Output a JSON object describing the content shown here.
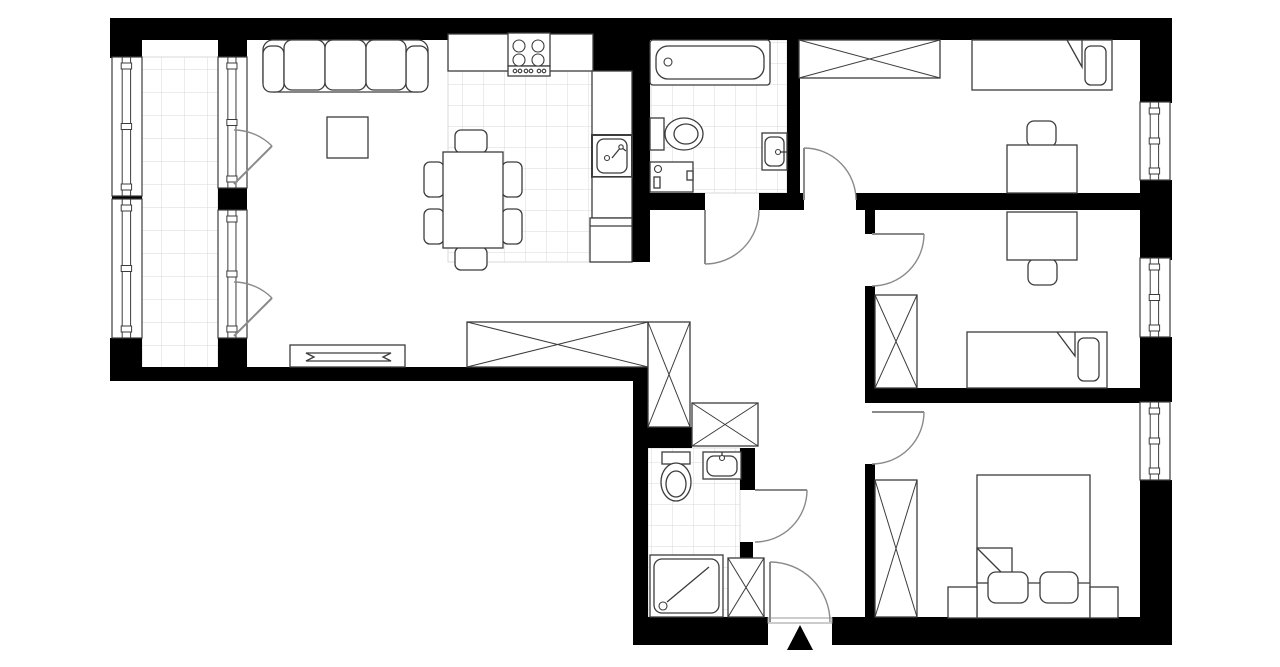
{
  "canvas": {
    "w": 1280,
    "h": 667
  },
  "palette": {
    "wall": "#000000",
    "furniture_line": "#3c3c3c",
    "door_line": "#8a8a8a",
    "tile_line": "#d9d9d9",
    "paper": "#ffffff",
    "threshold": "#9a9a9a"
  },
  "tile_areas": [
    {
      "name": "balcony-tiles",
      "x": 142,
      "y": 57,
      "w": 76,
      "h": 311,
      "cell": 23
    },
    {
      "name": "kitchen-tiles",
      "x": 448,
      "y": 71,
      "w": 184,
      "h": 191,
      "cell": 21
    },
    {
      "name": "bathroom1-tiles",
      "x": 650,
      "y": 40,
      "w": 137,
      "h": 153,
      "cell": 21
    },
    {
      "name": "bathroom2-tiles",
      "x": 648,
      "y": 448,
      "w": 92,
      "h": 169,
      "cell": 21
    }
  ],
  "walls": [
    {
      "name": "wall-top",
      "x": 110,
      "y": 18,
      "w": 1062,
      "h": 22
    },
    {
      "name": "wall-balcony-left-top",
      "x": 110,
      "y": 40,
      "w": 32,
      "h": 18
    },
    {
      "name": "wall-balcony-left-mid",
      "x": 112,
      "y": 194,
      "w": 30,
      "h": 5
    },
    {
      "name": "wall-balcony-left-bot",
      "x": 110,
      "y": 338,
      "w": 32,
      "h": 43
    },
    {
      "name": "wall-balcony-inner-top",
      "x": 218,
      "y": 40,
      "w": 29,
      "h": 18
    },
    {
      "name": "wall-balcony-inner-mid",
      "x": 218,
      "y": 188,
      "w": 29,
      "h": 22
    },
    {
      "name": "wall-balcony-inner-bot",
      "x": 218,
      "y": 338,
      "w": 29,
      "h": 43
    },
    {
      "name": "wall-living-bottom",
      "x": 110,
      "y": 367,
      "w": 538,
      "h": 14
    },
    {
      "name": "wall-kitchen-shaft",
      "x": 593,
      "y": 20,
      "w": 57,
      "h": 52
    },
    {
      "name": "wall-kitchen-bath",
      "x": 632,
      "y": 40,
      "w": 18,
      "h": 222
    },
    {
      "name": "wall-hall-north-1",
      "x": 632,
      "y": 193,
      "w": 73,
      "h": 17
    },
    {
      "name": "wall-hall-north-2",
      "x": 759,
      "y": 193,
      "w": 45,
      "h": 17
    },
    {
      "name": "wall-bedroom1-bottom",
      "x": 856,
      "y": 193,
      "w": 284,
      "h": 17
    },
    {
      "name": "wall-bath1-east",
      "x": 787,
      "y": 20,
      "w": 13,
      "h": 175
    },
    {
      "name": "wall-hall-east-a",
      "x": 865,
      "y": 210,
      "w": 10,
      "h": 24
    },
    {
      "name": "wall-hall-east-b",
      "x": 865,
      "y": 286,
      "w": 10,
      "h": 117
    },
    {
      "name": "wall-bedroom2-bottom",
      "x": 875,
      "y": 388,
      "w": 265,
      "h": 15
    },
    {
      "name": "wall-hall-east-c",
      "x": 865,
      "y": 464,
      "w": 10,
      "h": 155
    },
    {
      "name": "wall-hall-west-step",
      "x": 633,
      "y": 367,
      "w": 15,
      "h": 250
    },
    {
      "name": "wall-bath2-top",
      "x": 633,
      "y": 427,
      "w": 59,
      "h": 21
    },
    {
      "name": "wall-bath2-east-top",
      "x": 740,
      "y": 448,
      "w": 15,
      "h": 42
    },
    {
      "name": "wall-bath2-east-low",
      "x": 740,
      "y": 542,
      "w": 13,
      "h": 20
    },
    {
      "name": "wall-bottom-west",
      "x": 633,
      "y": 617,
      "w": 135,
      "h": 28
    },
    {
      "name": "wall-bottom-east",
      "x": 832,
      "y": 617,
      "w": 340,
      "h": 28
    },
    {
      "name": "wall-right-seg1",
      "x": 1140,
      "y": 40,
      "w": 32,
      "h": 63
    },
    {
      "name": "wall-right-seg2",
      "x": 1140,
      "y": 180,
      "w": 32,
      "h": 80
    },
    {
      "name": "wall-right-seg3",
      "x": 1140,
      "y": 337,
      "w": 32,
      "h": 65
    },
    {
      "name": "wall-right-seg4",
      "x": 1140,
      "y": 480,
      "w": 32,
      "h": 165
    }
  ],
  "windows": [
    {
      "name": "balcony-window-1",
      "x": 112,
      "y": 57,
      "w": 30,
      "h": 139
    },
    {
      "name": "balcony-window-2",
      "x": 112,
      "y": 199,
      "w": 30,
      "h": 139
    },
    {
      "name": "balcony-door-window-1",
      "x": 218,
      "y": 57,
      "w": 29,
      "h": 131
    },
    {
      "name": "balcony-door-window-2",
      "x": 218,
      "y": 210,
      "w": 29,
      "h": 128
    },
    {
      "name": "bedroom1-window",
      "x": 1140,
      "y": 102,
      "w": 30,
      "h": 78
    },
    {
      "name": "bedroom2-window",
      "x": 1140,
      "y": 258,
      "w": 30,
      "h": 79
    },
    {
      "name": "bedroom3-window",
      "x": 1140,
      "y": 402,
      "w": 30,
      "h": 78
    }
  ],
  "wardrobes": [
    {
      "name": "wardrobe-living",
      "x": 467,
      "y": 322,
      "w": 181,
      "h": 45
    },
    {
      "name": "wardrobe-hall",
      "x": 648,
      "y": 322,
      "w": 42,
      "h": 105
    },
    {
      "name": "wardrobe-hall-2",
      "x": 692,
      "y": 403,
      "w": 66,
      "h": 43
    },
    {
      "name": "wardrobe-bedroom1",
      "x": 799,
      "y": 40,
      "w": 141,
      "h": 38
    },
    {
      "name": "wardrobe-bedroom2",
      "x": 875,
      "y": 295,
      "w": 42,
      "h": 93
    },
    {
      "name": "wardrobe-bedroom3",
      "x": 875,
      "y": 480,
      "w": 42,
      "h": 137
    },
    {
      "name": "cabinet-entry",
      "x": 728,
      "y": 558,
      "w": 36,
      "h": 59
    }
  ],
  "doors": [
    {
      "name": "bathroom1-door",
      "leaf": [
        705,
        210,
        705,
        264
      ],
      "arc": "M 705 264 A 54 54 0 0 0 759 210"
    },
    {
      "name": "bedroom1-door",
      "leaf": [
        804,
        200,
        804,
        148
      ],
      "arc": "M 804 148 A 52 52 0 0 1 856 200"
    },
    {
      "name": "bedroom2-door",
      "leaf": [
        872,
        234,
        924,
        234
      ],
      "arc": "M 924 234 A 52 52 0 0 1 872 286"
    },
    {
      "name": "bedroom3-door",
      "leaf": [
        872,
        412,
        924,
        412
      ],
      "arc": "M 924 412 A 52 52 0 0 1 872 464"
    },
    {
      "name": "bathroom2-door",
      "leaf": [
        755,
        490,
        807,
        490
      ],
      "arc": "M 807 490 A 52 52 0 0 1 755 542"
    },
    {
      "name": "entrance-door",
      "leaf": [
        770,
        622,
        770,
        562
      ],
      "arc": "M 770 562 A 60 60 0 0 1 830 622"
    },
    {
      "name": "balcony-door-1",
      "leaf": [
        234,
        184,
        272,
        146
      ],
      "arc": "M 234 130 A 54 54 0 0 1 272 146"
    },
    {
      "name": "balcony-door-2",
      "leaf": [
        234,
        336,
        272,
        298
      ],
      "arc": "M 234 282 A 54 54 0 0 1 272 298"
    }
  ],
  "shapes": [
    {
      "el": "rect",
      "name": "entrance-threshold",
      "x": 768,
      "y": 618,
      "w": 64,
      "h": 5,
      "s": "#9a9a9a",
      "sw": 1
    },
    {
      "el": "rect",
      "name": "sofa-body",
      "x": 263,
      "y": 40,
      "w": 165,
      "h": 52,
      "rx": 10
    },
    {
      "el": "rect",
      "name": "sofa-armrest",
      "x": 263,
      "y": 46,
      "w": 21,
      "h": 46,
      "rx": 8
    },
    {
      "el": "rect",
      "name": "sofa-armrest",
      "x": 406,
      "y": 46,
      "w": 22,
      "h": 46,
      "rx": 8
    },
    {
      "el": "rect",
      "name": "sofa-cushion",
      "x": 284,
      "y": 40,
      "w": 41,
      "h": 50,
      "rx": 8
    },
    {
      "el": "rect",
      "name": "sofa-cushion",
      "x": 325,
      "y": 40,
      "w": 41,
      "h": 50,
      "rx": 8
    },
    {
      "el": "rect",
      "name": "sofa-cushion",
      "x": 366,
      "y": 40,
      "w": 40,
      "h": 50,
      "rx": 8
    },
    {
      "el": "rect",
      "name": "coffee-table",
      "x": 327,
      "y": 117,
      "w": 41,
      "h": 41
    },
    {
      "el": "rect",
      "name": "tv-stand",
      "x": 290,
      "y": 345,
      "w": 115,
      "h": 22
    },
    {
      "el": "polygon",
      "name": "tv",
      "pts": "306,353 391,353 383,357 391,361 306,361 314,357"
    },
    {
      "el": "rect",
      "name": "dining-chair",
      "x": 455,
      "y": 130,
      "w": 32,
      "h": 23,
      "rx": 6
    },
    {
      "el": "rect",
      "name": "dining-chair",
      "x": 455,
      "y": 247,
      "w": 32,
      "h": 23,
      "rx": 6
    },
    {
      "el": "rect",
      "name": "dining-chair",
      "x": 424,
      "y": 162,
      "w": 20,
      "h": 35,
      "rx": 6
    },
    {
      "el": "rect",
      "name": "dining-chair",
      "x": 424,
      "y": 209,
      "w": 20,
      "h": 35,
      "rx": 6
    },
    {
      "el": "rect",
      "name": "dining-chair",
      "x": 502,
      "y": 162,
      "w": 20,
      "h": 35,
      "rx": 6
    },
    {
      "el": "rect",
      "name": "dining-chair",
      "x": 502,
      "y": 209,
      "w": 20,
      "h": 35,
      "rx": 6
    },
    {
      "el": "rect",
      "name": "dining-table",
      "x": 443,
      "y": 152,
      "w": 60,
      "h": 96
    },
    {
      "el": "rect",
      "name": "kitchen-counter",
      "x": 448,
      "y": 34,
      "w": 145,
      "h": 37
    },
    {
      "el": "rect",
      "name": "stove",
      "x": 508,
      "y": 33,
      "w": 42,
      "h": 33
    },
    {
      "el": "rect",
      "name": "stove-knob-strip",
      "x": 508,
      "y": 66,
      "w": 42,
      "h": 10
    },
    {
      "el": "circle",
      "name": "stove-burner",
      "cx": 519,
      "cy": 46,
      "r": 6
    },
    {
      "el": "circle",
      "name": "stove-burner",
      "cx": 538,
      "cy": 46,
      "r": 6
    },
    {
      "el": "circle",
      "name": "stove-burner",
      "cx": 519,
      "cy": 60,
      "r": 6
    },
    {
      "el": "circle",
      "name": "stove-burner",
      "cx": 538,
      "cy": 60,
      "r": 6
    },
    {
      "el": "circle",
      "name": "stove-knob",
      "cx": 515,
      "cy": 71,
      "r": 1.8
    },
    {
      "el": "circle",
      "name": "stove-knob",
      "cx": 520,
      "cy": 71,
      "r": 1.8
    },
    {
      "el": "circle",
      "name": "stove-knob",
      "cx": 526,
      "cy": 71,
      "r": 1.8
    },
    {
      "el": "circle",
      "name": "stove-knob",
      "cx": 531,
      "cy": 71,
      "r": 1.8
    },
    {
      "el": "circle",
      "name": "stove-knob",
      "cx": 539,
      "cy": 71,
      "r": 1.8
    },
    {
      "el": "circle",
      "name": "stove-knob",
      "cx": 544,
      "cy": 71,
      "r": 1.8
    },
    {
      "el": "rect",
      "name": "kitchen-counter-right",
      "x": 592,
      "y": 71,
      "w": 40,
      "h": 64
    },
    {
      "el": "rect",
      "name": "kitchen-sink-unit",
      "x": 592,
      "y": 135,
      "w": 40,
      "h": 42,
      "sw": 2
    },
    {
      "el": "rect",
      "name": "kitchen-sink-basin",
      "x": 597,
      "y": 139,
      "w": 30,
      "h": 34,
      "rx": 7
    },
    {
      "el": "circle",
      "name": "sink-drain",
      "cx": 607,
      "cy": 158,
      "r": 2.5
    },
    {
      "el": "polyline",
      "name": "kitchen-faucet",
      "pts": "612,158 621,147 626,151"
    },
    {
      "el": "circle",
      "name": "kitchen-faucet-base",
      "cx": 621,
      "cy": 147,
      "r": 2.2
    },
    {
      "el": "rect",
      "name": "kitchen-counter-seg",
      "x": 592,
      "y": 177,
      "w": 40,
      "h": 41
    },
    {
      "el": "rect",
      "name": "fridge",
      "x": 590,
      "y": 218,
      "w": 42,
      "h": 44
    },
    {
      "el": "line",
      "name": "fridge-line",
      "x1": 590,
      "y1": 226,
      "x2": 632,
      "y2": 226
    },
    {
      "el": "rect",
      "name": "bathtub",
      "x": 650,
      "y": 40,
      "w": 120,
      "h": 45,
      "rx": 3
    },
    {
      "el": "rect",
      "name": "bathtub-basin",
      "x": 656,
      "y": 46,
      "w": 108,
      "h": 33,
      "rx": 12
    },
    {
      "el": "circle",
      "name": "bathtub-drain",
      "cx": 668,
      "cy": 62,
      "r": 4
    },
    {
      "el": "rect",
      "name": "toilet-tank",
      "x": 650,
      "y": 118,
      "w": 14,
      "h": 32
    },
    {
      "el": "ellipse",
      "name": "toilet-bowl",
      "cx": 684,
      "cy": 134,
      "rx": 19,
      "ry": 16
    },
    {
      "el": "ellipse",
      "name": "toilet-bowl-inner",
      "cx": 686,
      "cy": 134,
      "rx": 12,
      "ry": 10
    },
    {
      "el": "rect",
      "name": "washing-machine",
      "x": 650,
      "y": 162,
      "w": 43,
      "h": 30
    },
    {
      "el": "circle",
      "name": "washer-knob",
      "cx": 658,
      "cy": 169,
      "r": 3.5
    },
    {
      "el": "rect",
      "name": "washer-drawer",
      "x": 654,
      "y": 177,
      "w": 6,
      "h": 11
    },
    {
      "el": "rect",
      "name": "washer-handle",
      "x": 687,
      "y": 171,
      "w": 6,
      "h": 9
    },
    {
      "el": "rect",
      "name": "wash-basin-1",
      "x": 762,
      "y": 133,
      "w": 25,
      "h": 37
    },
    {
      "el": "rect",
      "name": "wash-basin-1-inner",
      "x": 765,
      "y": 137,
      "w": 19,
      "h": 29,
      "rx": 6
    },
    {
      "el": "circle",
      "name": "basin-1-faucet",
      "cx": 778,
      "cy": 152,
      "r": 2.5
    },
    {
      "el": "line",
      "name": "basin-1-spout",
      "x1": 780,
      "y1": 152,
      "x2": 787,
      "y2": 152
    },
    {
      "el": "rect",
      "name": "toilet2-tank",
      "x": 662,
      "y": 452,
      "w": 28,
      "h": 12
    },
    {
      "el": "ellipse",
      "name": "toilet2-bowl",
      "cx": 676,
      "cy": 482,
      "rx": 15,
      "ry": 19
    },
    {
      "el": "ellipse",
      "name": "toilet2-bowl-inner",
      "cx": 676,
      "cy": 484,
      "rx": 10,
      "ry": 13
    },
    {
      "el": "rect",
      "name": "wash-basin-2",
      "x": 703,
      "y": 452,
      "w": 38,
      "h": 27
    },
    {
      "el": "rect",
      "name": "wash-basin-2-inner",
      "x": 707,
      "y": 456,
      "w": 30,
      "h": 20,
      "rx": 7
    },
    {
      "el": "circle",
      "name": "basin-2-faucet",
      "cx": 722,
      "cy": 458,
      "r": 2.5
    },
    {
      "el": "line",
      "name": "basin-2-spout",
      "x1": 722,
      "y1": 452,
      "x2": 722,
      "y2": 456
    },
    {
      "el": "rect",
      "name": "shower-tray",
      "x": 650,
      "y": 555,
      "w": 73,
      "h": 62
    },
    {
      "el": "rect",
      "name": "shower-tray-inner",
      "x": 654,
      "y": 559,
      "w": 65,
      "h": 54,
      "rx": 8
    },
    {
      "el": "circle",
      "name": "shower-drain",
      "cx": 663,
      "cy": 606,
      "r": 4
    },
    {
      "el": "line",
      "name": "shower-door-line",
      "x1": 667,
      "y1": 602,
      "x2": 709,
      "y2": 567
    },
    {
      "el": "rect",
      "name": "bed-single-1",
      "x": 972,
      "y": 40,
      "w": 140,
      "h": 50
    },
    {
      "el": "polyline",
      "name": "bed-1-fold",
      "pts": "1067,40 1082,67 1082,40"
    },
    {
      "el": "rect",
      "name": "bed-1-pillow",
      "x": 1085,
      "y": 46,
      "w": 21,
      "h": 39,
      "rx": 6
    },
    {
      "el": "rect",
      "name": "desk-1-chair",
      "x": 1027,
      "y": 121,
      "w": 29,
      "h": 26,
      "rx": 7
    },
    {
      "el": "rect",
      "name": "desk-1",
      "x": 1007,
      "y": 145,
      "w": 70,
      "h": 48
    },
    {
      "el": "rect",
      "name": "desk-2-chair",
      "x": 1028,
      "y": 259,
      "w": 29,
      "h": 26,
      "rx": 7
    },
    {
      "el": "rect",
      "name": "desk-2",
      "x": 1007,
      "y": 212,
      "w": 70,
      "h": 48
    },
    {
      "el": "rect",
      "name": "bed-single-2",
      "x": 967,
      "y": 332,
      "w": 140,
      "h": 56
    },
    {
      "el": "polyline",
      "name": "bed-2-fold",
      "pts": "1057,332 1075,356 1075,332"
    },
    {
      "el": "rect",
      "name": "bed-2-pillow",
      "x": 1078,
      "y": 338,
      "w": 21,
      "h": 43,
      "rx": 6
    },
    {
      "el": "rect",
      "name": "bed-double",
      "x": 977,
      "y": 475,
      "w": 113,
      "h": 143
    },
    {
      "el": "rect",
      "name": "bed-3-fold-box",
      "x": 977,
      "y": 548,
      "w": 35,
      "h": 35
    },
    {
      "el": "line",
      "name": "bed-3-fold",
      "x1": 977,
      "y1": 548,
      "x2": 1012,
      "y2": 583
    },
    {
      "el": "line",
      "name": "bed-3-blanket-edge",
      "x1": 1012,
      "y1": 583,
      "x2": 1090,
      "y2": 583
    },
    {
      "el": "rect",
      "name": "bed-3-pillow",
      "x": 988,
      "y": 572,
      "w": 40,
      "h": 31,
      "rx": 8
    },
    {
      "el": "rect",
      "name": "bed-3-pillow",
      "x": 1040,
      "y": 572,
      "w": 38,
      "h": 31,
      "rx": 8
    },
    {
      "el": "rect",
      "name": "nightstand",
      "x": 948,
      "y": 587,
      "w": 29,
      "h": 31
    },
    {
      "el": "rect",
      "name": "nightstand",
      "x": 1090,
      "y": 587,
      "w": 28,
      "h": 31
    }
  ],
  "entrance_marker": {
    "name": "entrance-arrow",
    "points": "800,625 787,650 813,650"
  }
}
